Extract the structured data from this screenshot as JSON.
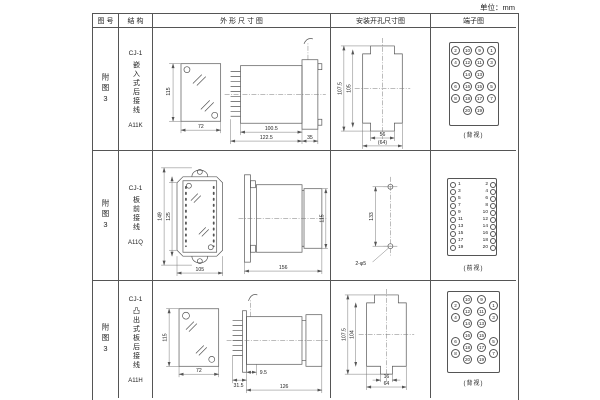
{
  "unit_label": "单位：mm",
  "header": {
    "figure_no": "图 号",
    "structure": "结 构",
    "outline": "外  形  尺  寸  图",
    "mounting": "安装开孔尺寸图",
    "terminal": "端子图"
  },
  "rows": [
    {
      "figure_no": "附图3",
      "structure": {
        "model": "CJ-1",
        "desc": "嵌入式后接线",
        "code": "A11K"
      },
      "outline": {
        "front_h": "115",
        "front_w": "72",
        "body_w": "100.5",
        "total_w": "122.5",
        "flange_w": "35"
      },
      "mounting": {
        "outer_h": "107.5",
        "inner_h": "105",
        "inner_w": "56",
        "outer_w": "(64)"
      },
      "terminal": {
        "view_label": "(背视)",
        "pins": [
          {
            "n": "2",
            "x": 20,
            "y": 18
          },
          {
            "n": "10",
            "x": 32,
            "y": 18
          },
          {
            "n": "9",
            "x": 44,
            "y": 18
          },
          {
            "n": "1",
            "x": 56,
            "y": 18
          },
          {
            "n": "4",
            "x": 20,
            "y": 30
          },
          {
            "n": "12",
            "x": 32,
            "y": 30
          },
          {
            "n": "11",
            "x": 44,
            "y": 30
          },
          {
            "n": "3",
            "x": 56,
            "y": 30
          },
          {
            "n": "14",
            "x": 32,
            "y": 42
          },
          {
            "n": "13",
            "x": 44,
            "y": 42
          },
          {
            "n": "6",
            "x": 20,
            "y": 54
          },
          {
            "n": "16",
            "x": 32,
            "y": 54
          },
          {
            "n": "15",
            "x": 44,
            "y": 54
          },
          {
            "n": "5",
            "x": 56,
            "y": 54
          },
          {
            "n": "8",
            "x": 20,
            "y": 66
          },
          {
            "n": "18",
            "x": 32,
            "y": 66
          },
          {
            "n": "17",
            "x": 44,
            "y": 66
          },
          {
            "n": "7",
            "x": 56,
            "y": 66
          },
          {
            "n": "20",
            "x": 32,
            "y": 78
          },
          {
            "n": "19",
            "x": 44,
            "y": 78
          }
        ]
      }
    },
    {
      "figure_no": "附图3",
      "structure": {
        "model": "CJ-1",
        "desc": "板前接线",
        "code": "A11Q"
      },
      "outline": {
        "front_h_outer": "149",
        "front_h_inner": "125",
        "front_w": "105",
        "side_w": "156",
        "side_h": "115"
      },
      "mounting": {
        "hole_dist": "133",
        "hole_spec": "2-φ5"
      },
      "terminal": {
        "view_label": "(前视)",
        "holes": [
          {
            "x": 19,
            "y": 31
          },
          {
            "x": 19,
            "y": 38
          },
          {
            "x": 19,
            "y": 45
          },
          {
            "x": 19,
            "y": 52
          },
          {
            "x": 19,
            "y": 59
          },
          {
            "x": 19,
            "y": 66
          },
          {
            "x": 19,
            "y": 73
          },
          {
            "x": 19,
            "y": 80
          },
          {
            "x": 19,
            "y": 87
          },
          {
            "x": 19,
            "y": 94
          },
          {
            "x": 59,
            "y": 31
          },
          {
            "x": 59,
            "y": 38
          },
          {
            "x": 59,
            "y": 45
          },
          {
            "x": 59,
            "y": 52
          },
          {
            "x": 59,
            "y": 59
          },
          {
            "x": 59,
            "y": 66
          },
          {
            "x": 59,
            "y": 73
          },
          {
            "x": 59,
            "y": 80
          },
          {
            "x": 59,
            "y": 87
          },
          {
            "x": 59,
            "y": 94
          }
        ],
        "nums_left": [
          {
            "n": "1",
            "x": 27,
            "y": 30
          },
          {
            "n": "3",
            "x": 27,
            "y": 37
          },
          {
            "n": "5",
            "x": 27,
            "y": 44
          },
          {
            "n": "7",
            "x": 27,
            "y": 51
          },
          {
            "n": "9",
            "x": 27,
            "y": 58
          },
          {
            "n": "11",
            "x": 27,
            "y": 65
          },
          {
            "n": "13",
            "x": 27,
            "y": 72
          },
          {
            "n": "15",
            "x": 27,
            "y": 79
          },
          {
            "n": "17",
            "x": 27,
            "y": 86
          },
          {
            "n": "19",
            "x": 27,
            "y": 93
          }
        ],
        "nums_right": [
          {
            "n": "2",
            "x": 45,
            "y": 30
          },
          {
            "n": "4",
            "x": 45,
            "y": 37
          },
          {
            "n": "6",
            "x": 45,
            "y": 44
          },
          {
            "n": "8",
            "x": 45,
            "y": 51
          },
          {
            "n": "10",
            "x": 45,
            "y": 58
          },
          {
            "n": "12",
            "x": 45,
            "y": 65
          },
          {
            "n": "14",
            "x": 45,
            "y": 72
          },
          {
            "n": "16",
            "x": 45,
            "y": 79
          },
          {
            "n": "18",
            "x": 45,
            "y": 86
          },
          {
            "n": "20",
            "x": 45,
            "y": 93
          }
        ]
      }
    },
    {
      "figure_no": "附图3",
      "structure": {
        "model": "CJ-1",
        "desc": "凸出式板后接线",
        "code": "A11H"
      },
      "outline": {
        "front_h": "115",
        "front_w": "72",
        "d1": "31.5",
        "d2": "9.5",
        "d3": "126"
      },
      "mounting": {
        "outer_h": "107.5",
        "inner_h": "104",
        "inner_w": "16",
        "outer_w": "64"
      },
      "terminal": {
        "view_label": "(背视)",
        "pins": [
          {
            "n": "10",
            "x": 32,
            "y": 14
          },
          {
            "n": "12",
            "x": 32,
            "y": 26
          },
          {
            "n": "14",
            "x": 32,
            "y": 38
          },
          {
            "n": "16",
            "x": 32,
            "y": 50
          },
          {
            "n": "18",
            "x": 32,
            "y": 62
          },
          {
            "n": "20",
            "x": 32,
            "y": 74
          },
          {
            "n": "2",
            "x": 20,
            "y": 20
          },
          {
            "n": "4",
            "x": 20,
            "y": 32
          },
          {
            "n": "6",
            "x": 20,
            "y": 56
          },
          {
            "n": "8",
            "x": 20,
            "y": 68
          },
          {
            "n": "9",
            "x": 46,
            "y": 14
          },
          {
            "n": "11",
            "x": 46,
            "y": 26
          },
          {
            "n": "13",
            "x": 46,
            "y": 38
          },
          {
            "n": "15",
            "x": 46,
            "y": 50
          },
          {
            "n": "17",
            "x": 46,
            "y": 62
          },
          {
            "n": "19",
            "x": 46,
            "y": 74
          },
          {
            "n": "1",
            "x": 58,
            "y": 20
          },
          {
            "n": "3",
            "x": 58,
            "y": 32
          },
          {
            "n": "5",
            "x": 58,
            "y": 56
          },
          {
            "n": "7",
            "x": 58,
            "y": 68
          }
        ]
      }
    }
  ]
}
